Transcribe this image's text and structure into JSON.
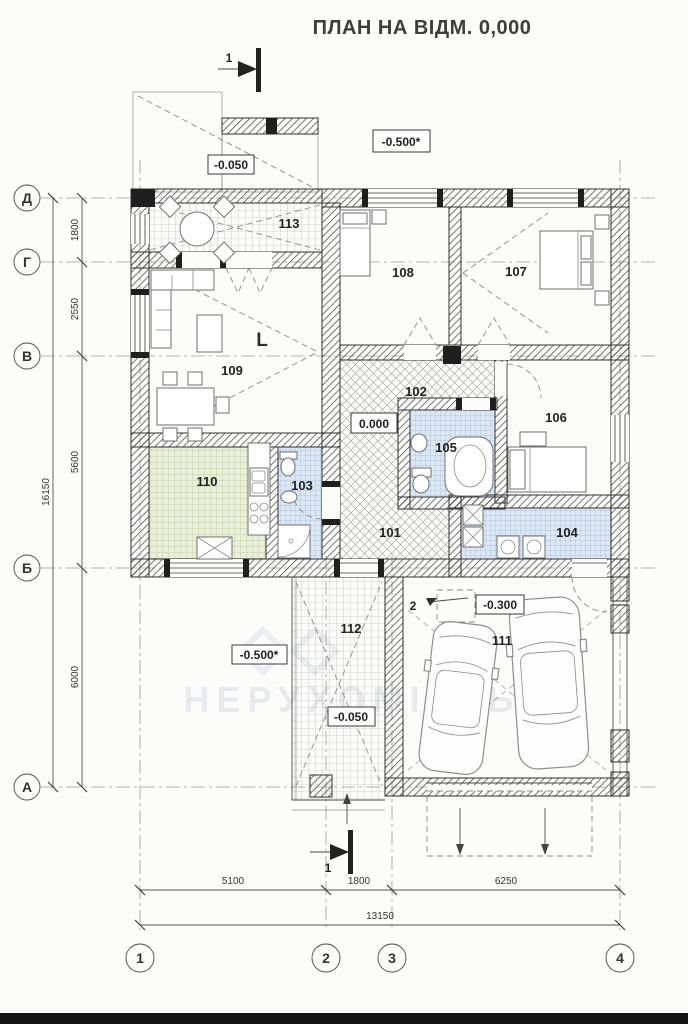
{
  "title": "ПЛАН НА ВІДМ. 0,000",
  "axes": {
    "rows": [
      {
        "label": "Д"
      },
      {
        "label": "Г"
      },
      {
        "label": "В"
      },
      {
        "label": "Б"
      },
      {
        "label": "А"
      }
    ],
    "cols": [
      {
        "label": "1"
      },
      {
        "label": "2"
      },
      {
        "label": "3"
      },
      {
        "label": "4"
      }
    ]
  },
  "dims": {
    "left": {
      "total": "16150",
      "segments": [
        "1800",
        "2550",
        "5600",
        "6000"
      ]
    },
    "bottom": {
      "total": "13150",
      "segments": [
        "5100",
        "1800",
        "6250"
      ]
    }
  },
  "rooms": {
    "r101": "101",
    "r102": "102",
    "r103": "103",
    "r104": "104",
    "r105": "105",
    "r106": "106",
    "r107": "107",
    "r108": "108",
    "r109": "109",
    "r110": "110",
    "r111": "111",
    "r112": "112",
    "r113": "113"
  },
  "elevations": {
    "terrace": "-0.050",
    "ground_top": "-0.500*",
    "hall": "0.000",
    "garage": "-0.300",
    "porch": "-0.050",
    "ground_porch": "-0.500*"
  },
  "markers": {
    "section_top": "1",
    "section_bottom": "1",
    "detail": "2",
    "column": "L"
  },
  "watermark": {
    "brand": "БГ",
    "word": "НЕРУХОМІСТЬ"
  },
  "colors": {
    "wall_hatch": "#4a4a4a",
    "tile_blue": "#dbe7f4",
    "tile_green": "#e9efda",
    "line": "#2f2f2f",
    "paper": "#fcfcfb"
  }
}
